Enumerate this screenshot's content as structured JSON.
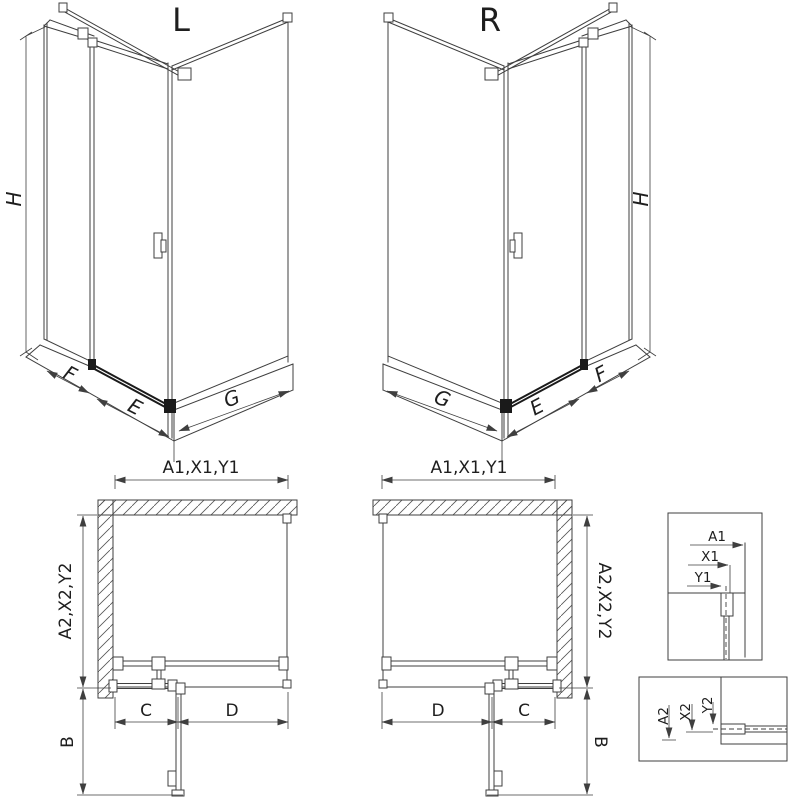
{
  "iso_left": {
    "title": "L",
    "h": "H",
    "f": "F",
    "e": "E",
    "g": "G"
  },
  "iso_right": {
    "title": "R",
    "h": "H",
    "f": "F",
    "e": "E",
    "g": "G"
  },
  "plan_left": {
    "width": "A1,X1,Y1",
    "depth": "A2,X2,Y2",
    "swing": "B",
    "seg_left": "C",
    "seg_right": "D"
  },
  "plan_right": {
    "width": "A1,X1,Y1",
    "depth": "A2,X2,Y2",
    "swing": "B",
    "seg_left": "D",
    "seg_right": "C"
  },
  "detail_width": {
    "a1": "A1",
    "x1": "X1",
    "y1": "Y1"
  },
  "detail_depth": {
    "a2": "A2",
    "x2": "X2",
    "y2": "Y2"
  },
  "colors": {
    "background": "#ffffff",
    "line": "#3f3f3f",
    "text": "#1e1e1e",
    "rail": "#1a1a1a"
  }
}
